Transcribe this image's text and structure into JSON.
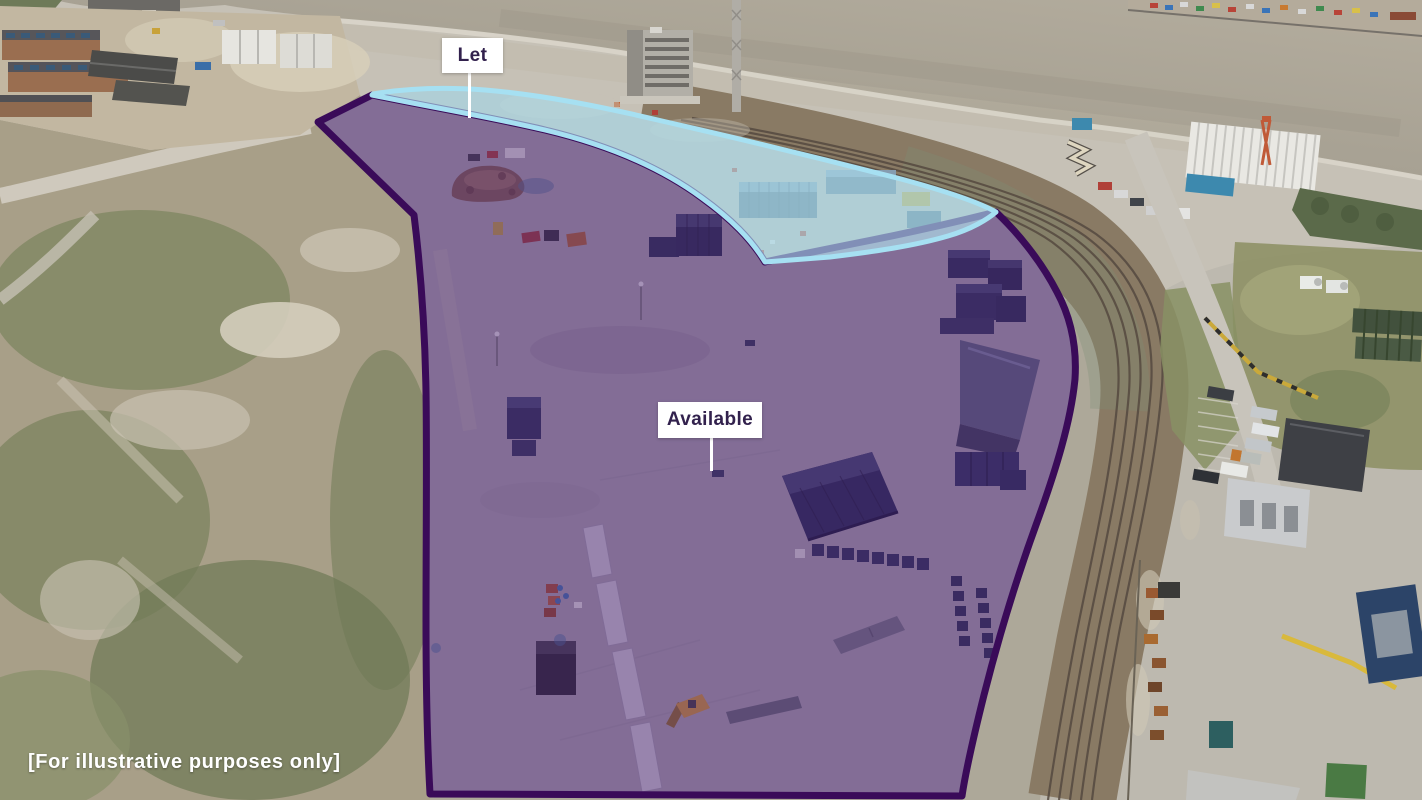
{
  "annotations": {
    "let": {
      "label": "Let"
    },
    "available": {
      "label": "Available"
    }
  },
  "caption": {
    "text": "[For illustrative purposes only]"
  },
  "colors": {
    "available-fill": "rgba(88,42,130,0.42)",
    "available-border": "#3a0b59",
    "let-fill": "rgba(173,224,240,0.62)",
    "let-border": "#a6e0f2",
    "label-bg": "#ffffff",
    "label-text": "#32214d",
    "caption-text": "#ffffff"
  }
}
